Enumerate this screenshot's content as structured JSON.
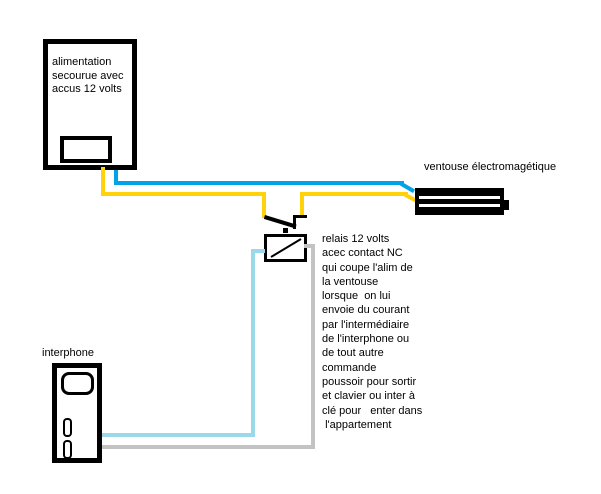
{
  "colors": {
    "background": "#FFFFFF",
    "outline": "#000000",
    "wire_positive_yellow": "#FFD20A",
    "wire_negative_blue": "#00A2E8",
    "wire_interphone_lightblue": "#99D9EA",
    "wire_interphone_gray": "#C3C3C3"
  },
  "power_supply": {
    "label": "alimentation\nsecourue avec\naccus 12 volts"
  },
  "ventouse": {
    "label": "ventouse électromagétique"
  },
  "relay": {
    "note": "relais 12 volts\nacec contact NC\nqui coupe l'alim de\nla ventouse\nlorsque  on lui\nenvoie du courant\npar l'intermédiaire\nde l'interphone ou\nde tout autre\ncommande\npoussoir pour sortir\net clavier ou inter à\nclé pour   enter dans\n l'appartement"
  },
  "interphone": {
    "label": "interphone"
  }
}
